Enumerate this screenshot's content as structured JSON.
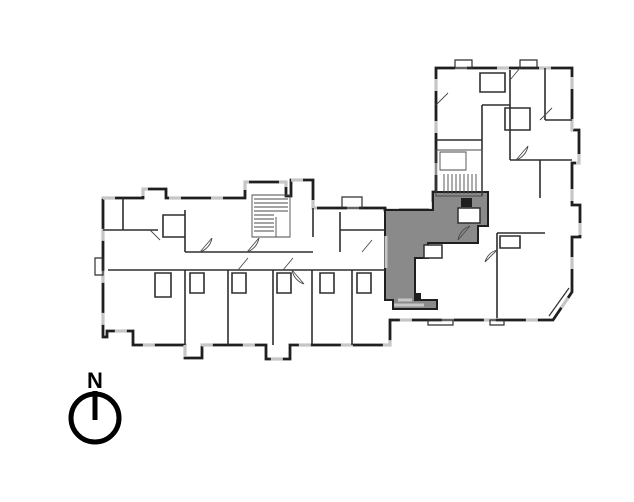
{
  "page": {
    "background": "#ffffff"
  },
  "compass": {
    "label": "N",
    "color": "#000000"
  },
  "colors": {
    "wall": "#1f1f1f",
    "interior": "#2e2e2e",
    "thin": "#4a4a4a",
    "window": "#c6c6c6",
    "paper": "#ffffff",
    "highlight_fill": "#8a8a8a",
    "highlight_stroke": "#1f1f1f"
  },
  "paths": {
    "building_outline": "M103,198 H143 V189 H166 V198 H245 V182 H286 V196 H291 V180 H313 V208 H385 V210 H433 V192 H436 V68 H572 V130 H579 V163 H572 V205 H580 V237 H572 V292 L553,320 H390 V345 H290 V359 H266 V345 H202 V358 H185 V345 H133 V331 H107 V337 H103 Z",
    "highlight_unit": "M385,210 H433 V192 H488 V226 H478 V243 H428 V258 H415 V300 H437 V309 H393 V300 H385 Z",
    "highlight_windows": "M386,236 V268 M394,305 H424 M398,300 H412",
    "highlight_rooms": "M458,208 H480 V223 H458 Z M424,245 H442 V258 H424 Z",
    "interior_left_wing": "M108,270 H385 M185,252 H313 M185,270 V345 M228,270 V345 M273,270 V345 M312,270 V345 M352,270 V345 M123,198 V230 M103,230 H158 M185,210 V252 M163,215 H185 V237 H163 Z M313,208 V237 M340,212 V252 M340,230 H385 M155,273 H171 V297 H155 Z M190,273 H204 V293 H190 Z M232,273 H246 V293 H232 Z M277,273 H291 V293 H277 Z M320,273 H334 V293 H320 Z M357,273 H371 V293 H357 Z",
    "interior_right_wing": "M436,140 H482 M482,105 V196 M482,105 H510 M510,70 V160 M510,160 H572 M545,68 V120 M545,120 H572 M497,233 V318 M497,233 H545 M480,73 H505 V92 H480 Z M505,108 H530 V130 H505 Z M500,236 H520 V248 H500 Z M540,160 V198",
    "stairs": "M252,195 H290 V237 H252 Z M276,217 V237 M254,199 H288 M254,203 H288 M254,207 H288 M254,211 H288 M254,215 H274 M254,219 H274 M254,223 H274 M254,227 H274 M254,231 H274 M436,150 H482 V196 H436 Z M440,152 H466 V170 H440 Z M444,174 V194 M448,174 V194 M452,174 V194 M456,174 V194 M460,174 V194 M464,174 V194 M468,174 V194 M472,174 V194 M476,174 V194",
    "balconies": "M428,320 H453 V325 H428 Z M490,320 H504 V325 H490 Z M95,258 H103 V275 H95 Z M342,197 H362 V208 H342 Z M455,60 H472 V68 H455 Z M520,60 H537 V68 H520 Z M549,316 L569,288",
    "dark_boxes": "M461,198 H472 V207 H461 Z M415,293 H421 V300 H415 Z",
    "doors": "M200,252 L212,238 M212,238 A18,18 0 0 1 200,252 M247,252 L259,238 M259,238 A18,18 0 0 1 247,252 M292,270 L304,284 M292,270 A18,18 0 0 0 304,284 M470,226 L458,240 M458,240 A18,18 0 0 1 470,226 M516,160 L528,146 M528,146 A18,18 0 0 1 516,160 M497,250 L485,262 M485,262 A17,17 0 0 1 497,250 M150,230 L160,240 M238,270 L248,258 M283,270 L293,258 M362,252 L372,240 M540,120 L552,108 M520,68 L510,80 M436,105 L448,93"
  }
}
